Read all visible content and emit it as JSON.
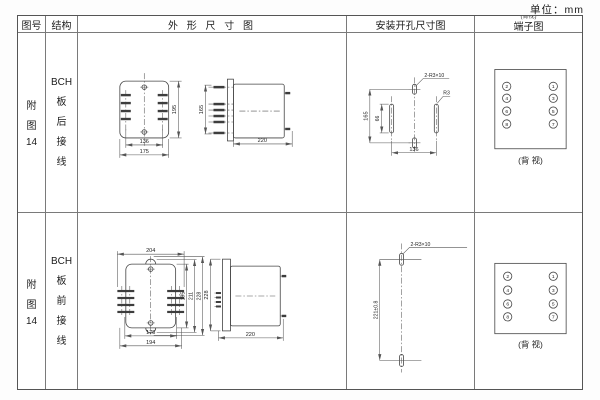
{
  "meta": {
    "unit_label": "单位：mm"
  },
  "table": {
    "headers": {
      "fig_no": "图号",
      "structure": "结构",
      "outline": "外 形 尺 寸 图",
      "mounting": "安装开孔尺寸图",
      "terminal": "端子图",
      "terminal_small_note": "(背视)"
    },
    "rows": [
      {
        "fig_no": {
          "l1": "附",
          "l2": "图",
          "l3": "14"
        },
        "structure": {
          "l1": "BCH",
          "l2": "板",
          "l3": "后",
          "l4": "接",
          "l5": "线"
        },
        "outline": {
          "front_inner_width": "136",
          "front_width": "175",
          "front_height": "195",
          "stud_span": "165",
          "depth": "220"
        },
        "mounting": {
          "hole_label": "2-R3×10",
          "radius_label": "R3",
          "height": "165",
          "slot_height": "66",
          "width": "136"
        },
        "terminal": {
          "left": [
            "2",
            "4",
            "6",
            "8"
          ],
          "right": [
            "1",
            "3",
            "5",
            "7"
          ],
          "view_note": "(背 视)"
        }
      },
      {
        "fig_no": {
          "l1": "附",
          "l2": "图",
          "l3": "14"
        },
        "structure": {
          "l1": "BCH",
          "l2": "板",
          "l3": "前",
          "l4": "接",
          "l5": "线"
        },
        "outline": {
          "top_width": "204",
          "inner_width": "175",
          "bottom_width": "194",
          "height_inner": "195",
          "height_mid": "211",
          "height_outer": "228",
          "side_height": "228",
          "depth": "220"
        },
        "mounting": {
          "hole_label": "2-R3×10",
          "hole_spacing": "221±0.8"
        },
        "terminal": {
          "left": [
            "2",
            "4",
            "6",
            "8"
          ],
          "right": [
            "1",
            "3",
            "5",
            "7"
          ],
          "view_note": "(背 视)"
        }
      }
    ]
  }
}
